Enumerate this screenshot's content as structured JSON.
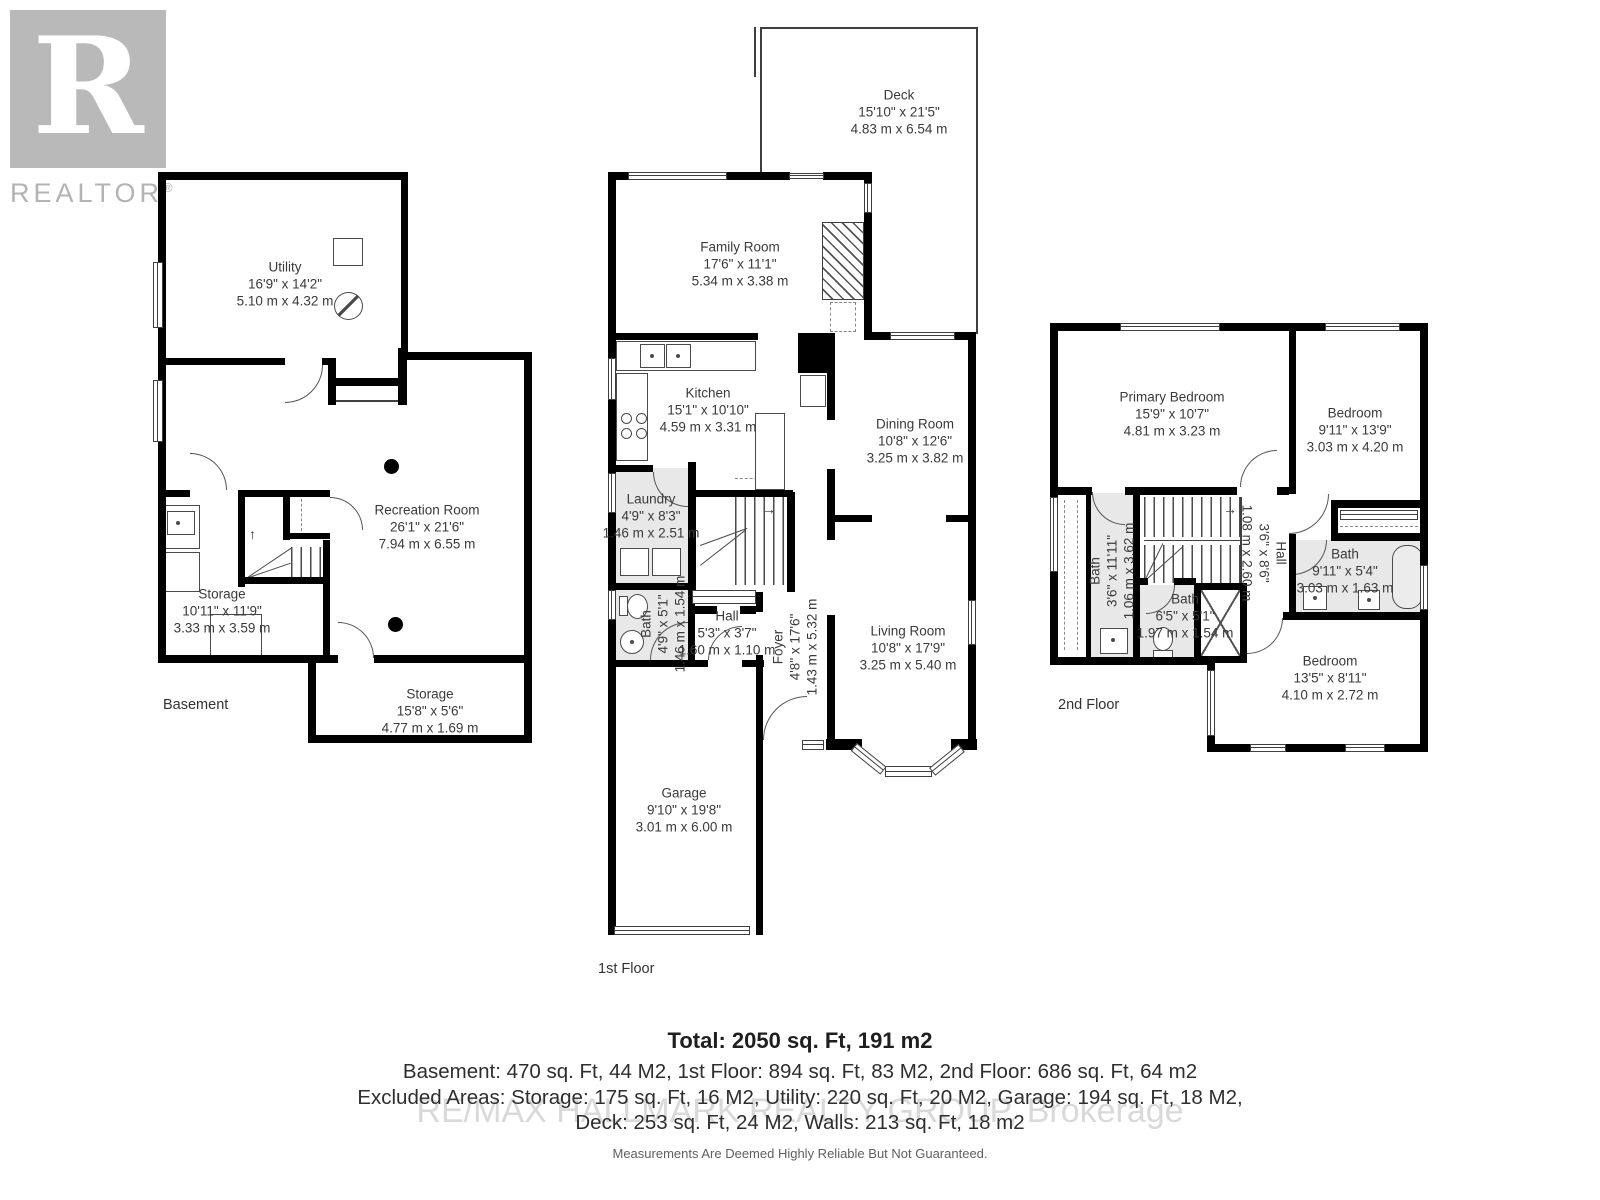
{
  "logo": {
    "letter": "R",
    "brand": "REALTOR",
    "registered": "®"
  },
  "floors": {
    "basement": {
      "title": "Basement",
      "stairs_arrow": "↑",
      "rooms": {
        "utility": {
          "name": "Utility",
          "dims_ft": "16'9\" x 14'2\"",
          "dims_m": "5.10 m x 4.32 m"
        },
        "recreation": {
          "name": "Recreation Room",
          "dims_ft": "26'1\" x 21'6\"",
          "dims_m": "7.94 m x 6.55 m"
        },
        "storage1": {
          "name": "Storage",
          "dims_ft": "10'11\" x 11'9\"",
          "dims_m": "3.33 m x 3.59 m"
        },
        "storage2": {
          "name": "Storage",
          "dims_ft": "15'8\" x 5'6\"",
          "dims_m": "4.77 m x 1.69 m"
        }
      }
    },
    "first": {
      "title": "1st Floor",
      "stairs_arrow": "→",
      "rooms": {
        "deck": {
          "name": "Deck",
          "dims_ft": "15'10\" x 21'5\"",
          "dims_m": "4.83 m x 6.54 m"
        },
        "family": {
          "name": "Family Room",
          "dims_ft": "17'6\" x 11'1\"",
          "dims_m": "5.34 m x 3.38 m"
        },
        "kitchen": {
          "name": "Kitchen",
          "dims_ft": "15'1\" x 10'10\"",
          "dims_m": "4.59 m x 3.31 m"
        },
        "dining": {
          "name": "Dining Room",
          "dims_ft": "10'8\" x 12'6\"",
          "dims_m": "3.25 m x 3.82 m"
        },
        "laundry": {
          "name": "Laundry",
          "dims_ft": "4'9\" x 8'3\"",
          "dims_m": "1.46 m x 2.51 m"
        },
        "bath": {
          "name": "Bath",
          "dims_ft": "4'9\" x 5'1\"",
          "dims_m": "1.46 m x 1.54 m"
        },
        "hall": {
          "name": "Hall",
          "dims_ft": "5'3\" x 3'7\"",
          "dims_m": "1.60 m x 1.10 m"
        },
        "foyer": {
          "name": "Foyer",
          "dims_ft": "4'8\" x 17'6\"",
          "dims_m": "1.43 m x 5.32 m"
        },
        "living": {
          "name": "Living Room",
          "dims_ft": "10'8\" x 17'9\"",
          "dims_m": "3.25 m x 5.40 m"
        },
        "garage": {
          "name": "Garage",
          "dims_ft": "9'10\" x 19'8\"",
          "dims_m": "3.01 m x 6.00 m"
        }
      }
    },
    "second": {
      "title": "2nd Floor",
      "stairs_arrow": "→",
      "rooms": {
        "primary": {
          "name": "Primary Bedroom",
          "dims_ft": "15'9\" x 10'7\"",
          "dims_m": "4.81 m x 3.23 m"
        },
        "bedroom2": {
          "name": "Bedroom",
          "dims_ft": "9'11\" x 13'9\"",
          "dims_m": "3.03 m x 4.20 m"
        },
        "bath_long": {
          "name": "Bath",
          "dims_ft": "3'6\" x 11'11\"",
          "dims_m": "1.06 m x 3.62 m"
        },
        "hall": {
          "name": "Hall",
          "dims_ft": "3'6\" x 8'6\"",
          "dims_m": "1.08 m x 2.60 m"
        },
        "bath_small": {
          "name": "Bath",
          "dims_ft": "6'5\" x 5'1\"",
          "dims_m": "1.97 m x 1.54 m"
        },
        "bath_main": {
          "name": "Bath",
          "dims_ft": "9'11\" x 5'4\"",
          "dims_m": "3.03 m x 1.63 m"
        },
        "bedroom3": {
          "name": "Bedroom",
          "dims_ft": "13'5\" x 8'11\"",
          "dims_m": "4.10 m x 2.72 m"
        }
      }
    }
  },
  "summary": {
    "total": "Total: 2050 sq. Ft, 191 m2",
    "line1": "Basement: 470 sq. Ft, 44 M2, 1st Floor: 894 sq. Ft, 83 M2, 2nd Floor: 686 sq. Ft, 64 m2",
    "line2": "Excluded Areas: Storage: 175 sq. Ft, 16 M2, Utility: 220 sq. Ft, 20 M2, Garage: 194 sq. Ft, 18 M2,",
    "line3": "Deck: 253 sq. Ft, 24 M2, Walls: 213 sq. Ft, 18 m2",
    "watermark": "RE/MAX HALLMARK REALTY GROUP, Brokerage",
    "disclaimer": "Measurements Are Deemed Highly Reliable But Not Guaranteed."
  }
}
